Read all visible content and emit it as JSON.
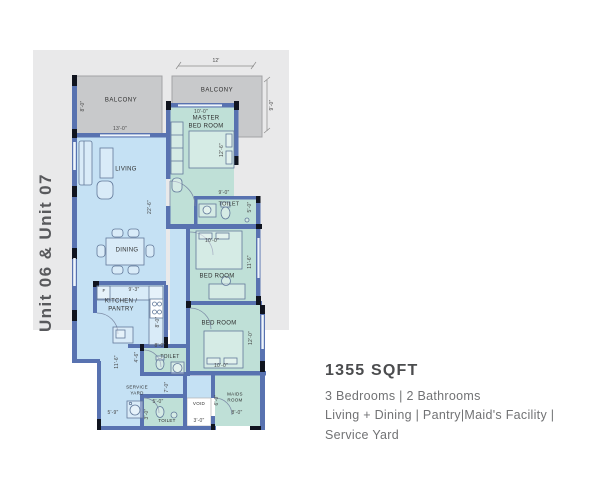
{
  "unit_title": "Unit 06 & Unit 07",
  "summary": {
    "area": "1355 SQFT",
    "lines": [
      "3 Bedrooms | 2 Bathrooms",
      "Living + Dining | Pantry|Maid's Facility |",
      "Service Yard"
    ]
  },
  "colors": {
    "backdrop": "#e9e9ea",
    "balcony": "#c8c9cb",
    "living_zone": "#c5e1f4",
    "bed_zone": "#bfe0d7",
    "wall": "#5872b0",
    "column": "#10141f"
  },
  "plan": {
    "balcony_left": {
      "label": "BALCONY",
      "dim_h": "8'-0\""
    },
    "balcony_top": {
      "label": "BALCONY",
      "dim_w": "12'",
      "dim_h": "9'-0\""
    },
    "living": {
      "label": "LIVING",
      "dim_w": "13'-0\"",
      "dim_h": "22'-6\""
    },
    "dining": {
      "label": "DINING"
    },
    "master": {
      "label": "MASTER BED ROOM",
      "dim_w": "10'-0\"",
      "dim_h": "12'-6\""
    },
    "toilet_master": {
      "label": "TOILET",
      "dim_w": "9'-0\"",
      "dim_h": "5'-0\""
    },
    "bedroom1": {
      "label": "BED ROOM",
      "dim_w": "10'-0\"",
      "dim_h": "11'-6\""
    },
    "bedroom2": {
      "label": "BED ROOM",
      "dim_w": "10'-0\"",
      "dim_h": "12'-0\""
    },
    "kitchen": {
      "label": "KITCHEN / PANTRY",
      "dim_w": "9'-3\"",
      "dim_h": "8'-0\"",
      "fridge": "F"
    },
    "toilet_kitchen": {
      "label": "TOILET",
      "dim_w": "8'-0\"",
      "dim_h": "4'-6\""
    },
    "service_yard": {
      "label": "SERVICE YARD",
      "dim_w": "5'-9\"",
      "dim_h": "11'-6\"",
      "dim_h2": "7'-0\""
    },
    "toilet_small": {
      "label": "TOILET",
      "dim_w": "5'-0\"",
      "dim_h": "3'-0\""
    },
    "void": {
      "label": "VOID",
      "dim_w": "3'-0\""
    },
    "maids": {
      "label": "MAIDS ROOM",
      "dim_w": "8'-0\"",
      "dim_h": "6'-0\""
    }
  }
}
